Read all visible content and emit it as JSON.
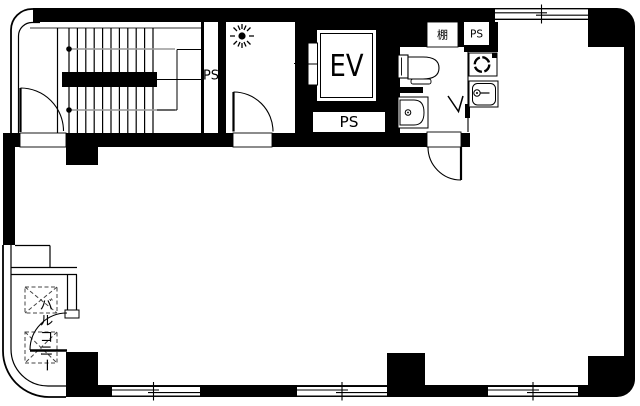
{
  "plan": {
    "type": "architectural-floor-plan",
    "colors": {
      "wall": "#000000",
      "background": "#ffffff",
      "guide_gray": "#8a8a8a",
      "hatch_gray": "#444444"
    },
    "labels": {
      "stair_shaft_ps": "PS",
      "elevator": "EV",
      "elevator_shaft_ps": "PS",
      "shelf": "棚",
      "kitchen_ps": "PS",
      "balcony": "バルコニー",
      "balcony_chars": [
        "バ",
        "ル",
        "コ",
        "ニ",
        "ー"
      ]
    },
    "fixtures": {
      "staircase": "staircase-with-handrail",
      "ceiling_light": "ceiling-light-icon",
      "elevator_doors": "elevator-door-panels",
      "toilet": "toilet-fixture",
      "wash_basin": "wash-basin-fixture",
      "burner": "round-burner-fixture",
      "kitchen_sink": "kitchen-sink-fixture",
      "folding_door": "v-folding-door-mark",
      "windows": "sliding-window-symbol",
      "doors": "swing-door-arc"
    }
  }
}
